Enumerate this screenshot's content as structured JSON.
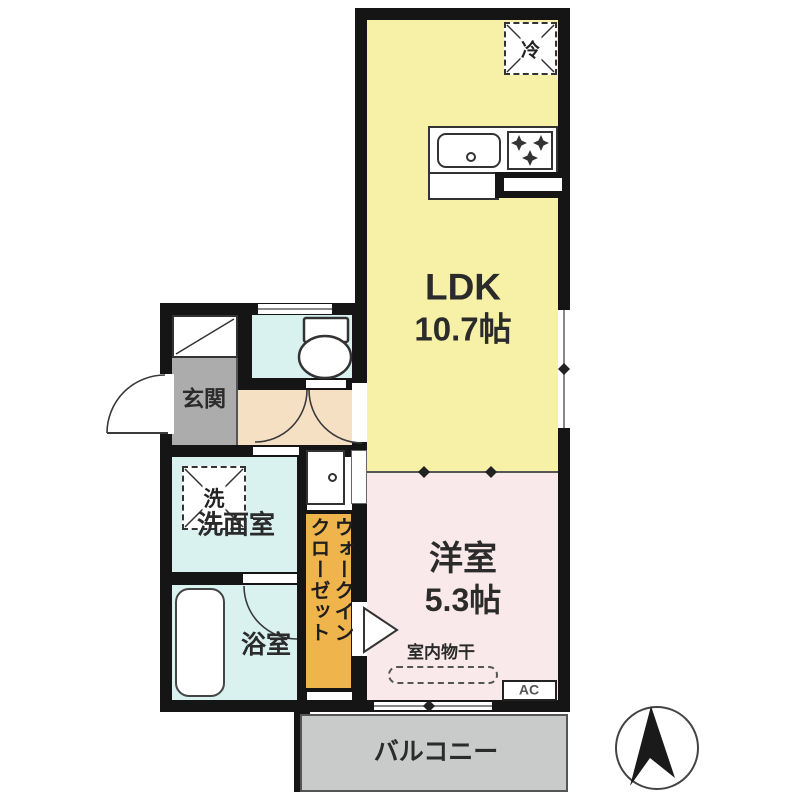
{
  "plan": {
    "rooms": {
      "ldk": {
        "label": "LDK",
        "size": "10.7帖",
        "color": "#F6F1A6"
      },
      "bedroom": {
        "label": "洋室",
        "size": "5.3帖",
        "color": "#FAE9EB"
      },
      "entrance": {
        "label": "玄関",
        "color": "#ACACAC"
      },
      "washroom": {
        "label": "洗面室",
        "color": "#D9F2F0"
      },
      "bathroom": {
        "label": "浴室",
        "color": "#D9F2F0"
      },
      "toilet": {
        "color": "#D9F2F0"
      },
      "hall": {
        "color": "#F6E0C3"
      },
      "wic": {
        "line1": "ウォークイン",
        "line2": "クローゼット",
        "color": "#EFB44B"
      },
      "balcony": {
        "label": "バルコニー",
        "color": "#C9CACA"
      }
    },
    "fixtures": {
      "refrigerator": "冷",
      "washer": "洗",
      "indoor_drying": "室内物干",
      "air_conditioner": "AC"
    },
    "colors": {
      "wall": "#151515",
      "door_line": "#3a3a3a",
      "text": "#2b2b2b"
    }
  }
}
